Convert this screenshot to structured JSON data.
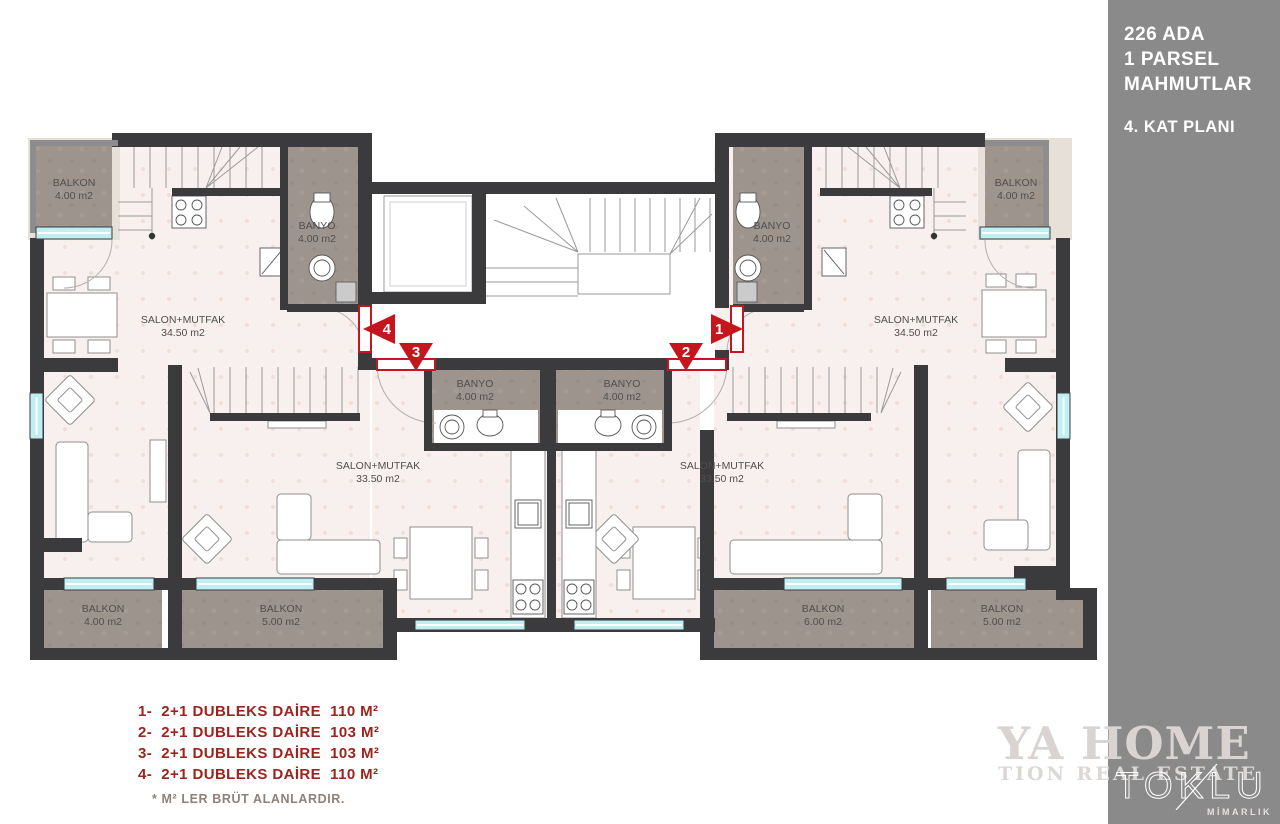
{
  "sidebar": {
    "line1": "226 ADA",
    "line2": "1 PARSEL",
    "line3": "MAHMUTLAR",
    "plan_label": "4. KAT PLANI",
    "brand": "TOKLU",
    "brand_sub": "MİMARLIK"
  },
  "watermark": {
    "line1": "YA HOME",
    "line2": "TION REAL ESTATE"
  },
  "legend": {
    "items": [
      "1-  2+1 DUBLEKS DAİRE  110 M²",
      "2-  2+1 DUBLEKS DAİRE  103 M²",
      "3-  2+1 DUBLEKS DAİRE  103 M²",
      "4-  2+1 DUBLEKS DAİRE  110 M²"
    ],
    "note": "* M² LER BRÜT ALANLARDIR."
  },
  "rooms": {
    "balkon_tl": {
      "name": "BALKON",
      "area": "4.00 m2"
    },
    "balkon_tr": {
      "name": "BALKON",
      "area": "4.00 m2"
    },
    "banyo_u4": {
      "name": "BANYO",
      "area": "4.00 m2"
    },
    "banyo_u1": {
      "name": "BANYO",
      "area": "4.00 m2"
    },
    "salon_u4": {
      "name": "SALON+MUTFAK",
      "area": "34.50 m2"
    },
    "salon_u1": {
      "name": "SALON+MUTFAK",
      "area": "34.50 m2"
    },
    "banyo_u3": {
      "name": "BANYO",
      "area": "4.00 m2"
    },
    "banyo_u2": {
      "name": "BANYO",
      "area": "4.00 m2"
    },
    "salon_u3": {
      "name": "SALON+MUTFAK",
      "area": "33.50 m2"
    },
    "salon_u2": {
      "name": "SALON+MUTFAK",
      "area": "33.50 m2"
    },
    "balkon_b1": {
      "name": "BALKON",
      "area": "4.00 m2"
    },
    "balkon_b2": {
      "name": "BALKON",
      "area": "5.00 m2"
    },
    "balkon_b3": {
      "name": "BALKON",
      "area": "6.00 m2"
    },
    "balkon_b4": {
      "name": "BALKON",
      "area": "5.00 m2"
    }
  },
  "markers": {
    "m1": "1",
    "m2": "2",
    "m3": "3",
    "m4": "4"
  },
  "colors": {
    "wall": "#3b3b3d",
    "floor": "#f8f0ee",
    "balcony": "#9e948e",
    "window": "#bfeef3",
    "marker_red": "#c4161c",
    "legend_red": "#9b241d",
    "sidebar_gray": "#8a8a8a"
  }
}
